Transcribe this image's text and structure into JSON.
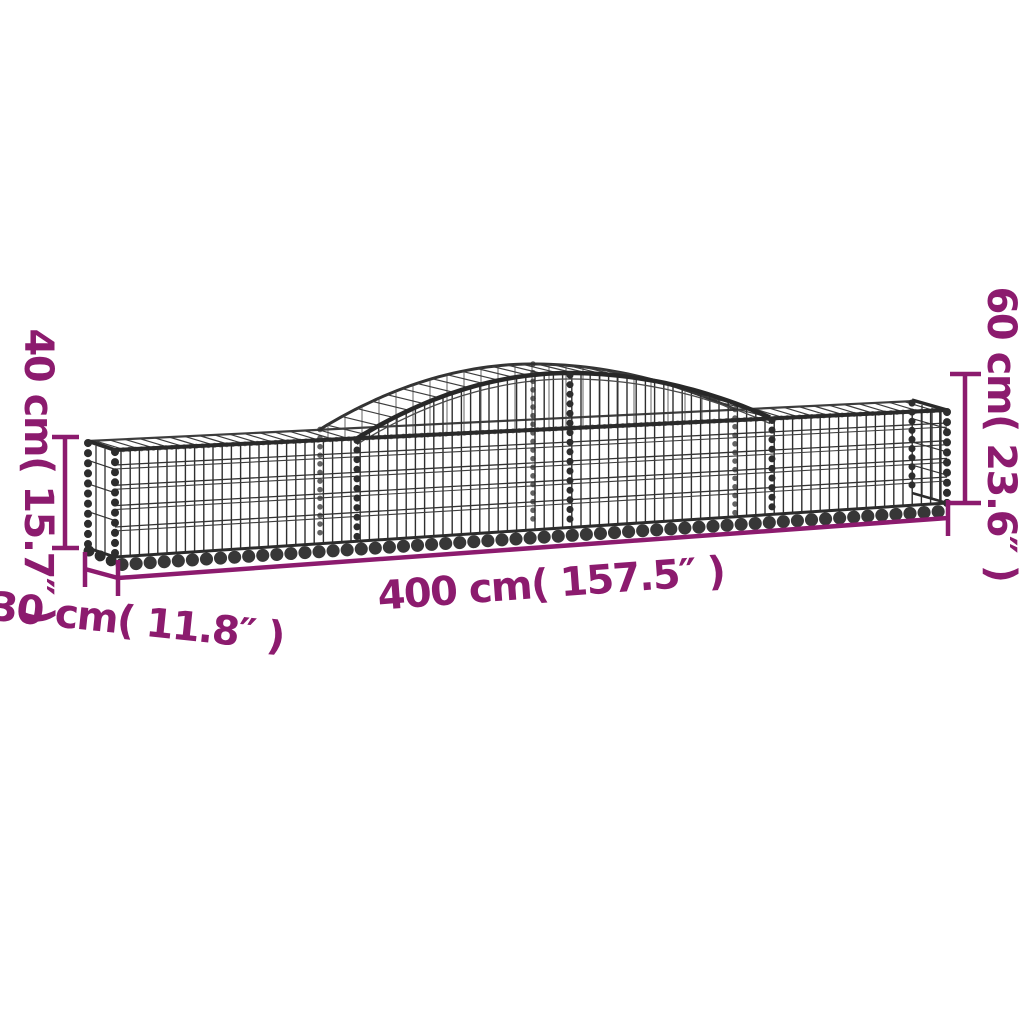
{
  "diagram": {
    "figure": "arched-gabion-basket",
    "annotations": {
      "left_height": "40 cm( 15.7″ )",
      "right_height": "60 cm( 23.6″ )",
      "length": "400 cm( 157.5″ )",
      "depth": "30 cm( 11.8″ )"
    },
    "colors": {
      "annotation": "#8C1B6E",
      "wire": "#2E2E2E",
      "background": "#FFFFFF"
    }
  }
}
